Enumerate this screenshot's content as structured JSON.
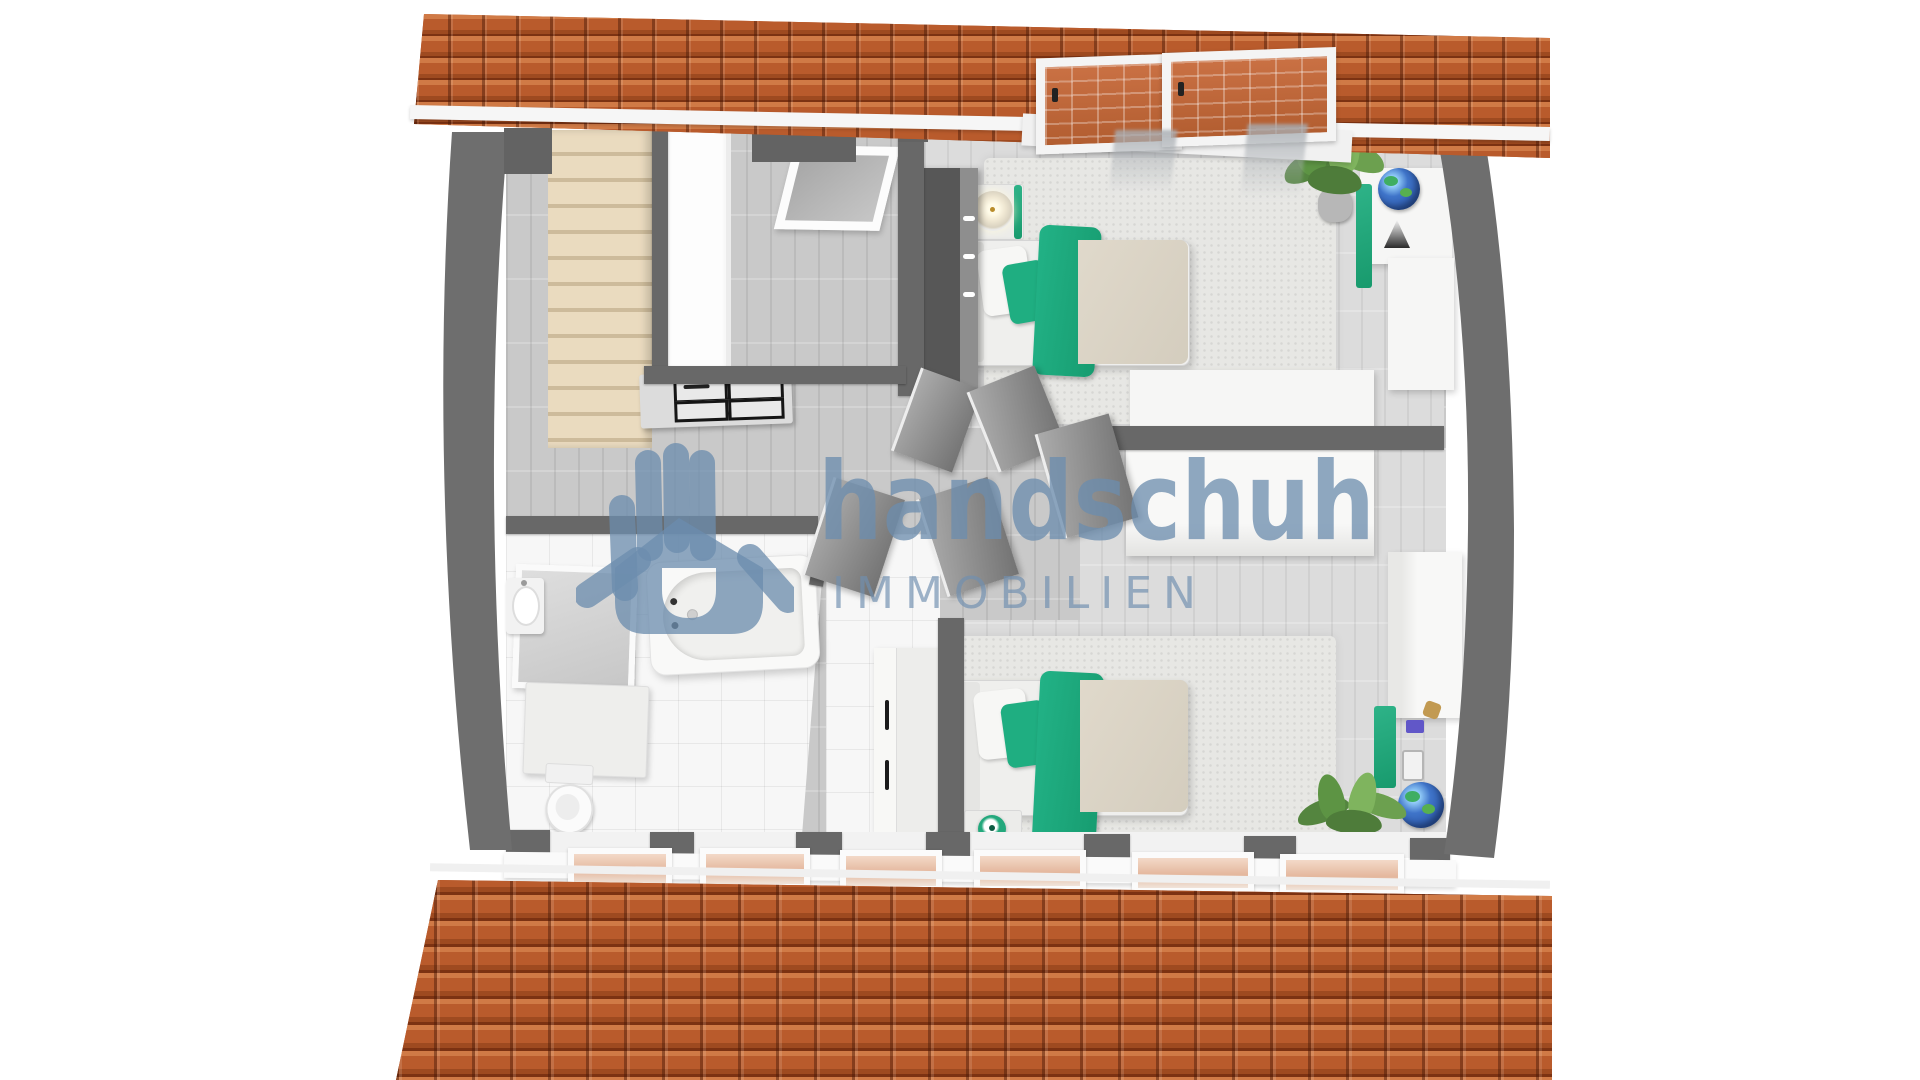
{
  "image_type": "3d-rendered attic floor plan, top-down view",
  "watermark": {
    "brand": "handschuh",
    "tagline": "IMMOBILIEN",
    "logo": "hand-house-logo",
    "color": "#6c8cad"
  },
  "palette": {
    "roof_tile": "#b45427",
    "roof_gap": "#7c3212",
    "wall_grey": "#686868",
    "floor_hall": "#c9c9c9",
    "floor_bedroom": "#dcdcdc",
    "floor_bath": "#f7f7f7",
    "accent_green": "#1fae81",
    "duvet_beige": "#dcd5c7",
    "stairs_beige": "#eadbbf"
  },
  "rooms": [
    {
      "name": "staircase-landing",
      "objects": [
        "staircase",
        "stairwell-railing",
        "dresser-with-drawers",
        "floor-skylight"
      ]
    },
    {
      "name": "hallway",
      "objects": [
        "open-door",
        "open-door",
        "open-door",
        "open-door",
        "open-door"
      ]
    },
    {
      "name": "bedroom-top",
      "objects": [
        "single-bed-green-bedding",
        "nightstand-with-lamp",
        "dark-wardrobe",
        "rug",
        "potted-plant",
        "globe",
        "shelf-unit",
        "sideboard",
        "roof-windows-with-curtains"
      ]
    },
    {
      "name": "bedroom-bottom",
      "objects": [
        "single-bed-green-bedding",
        "nightstand-with-ball-lamp",
        "rug",
        "wardrobe",
        "desk",
        "globe",
        "potted-plant",
        "closet-with-handles"
      ]
    },
    {
      "name": "bathroom",
      "objects": [
        "bathtub",
        "shower",
        "washbasin",
        "toilet",
        "vanity-cabinet",
        "tiled-floor"
      ]
    }
  ],
  "exterior": [
    "orange-tile-roof-strip-top",
    "orange-tile-roof-bottom",
    "knee-wall-roof-windows",
    "curved-side-walls"
  ]
}
